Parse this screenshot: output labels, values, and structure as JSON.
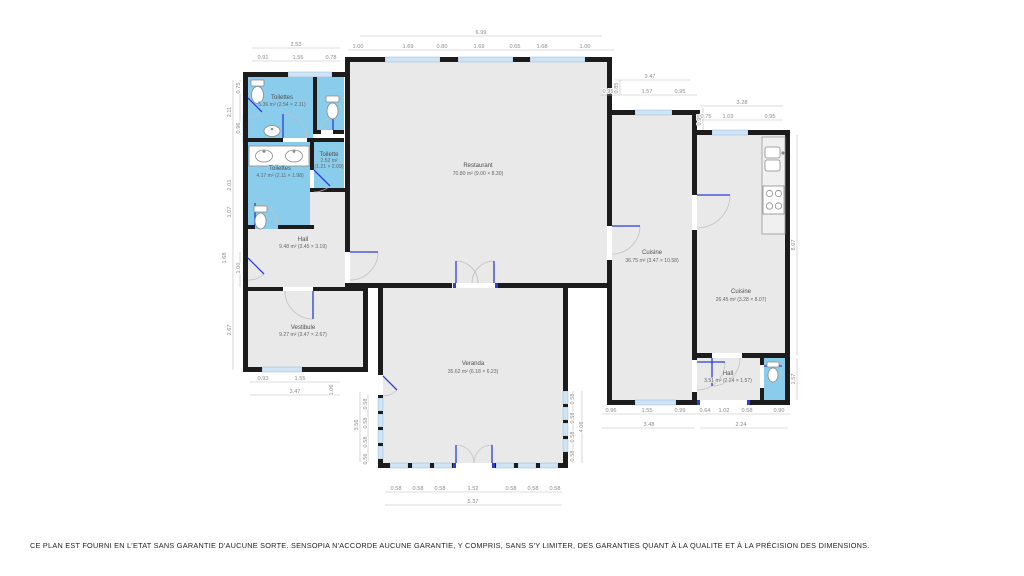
{
  "disclaimer": "CE PLAN EST FOURNI EN L'ETAT SANS GARANTIE D'AUCUNE SORTE. SENSOPIA N'ACCORDE AUCUNE GARANTIE, Y COMPRIS, SANS S'Y LIMITER, DES GARANTIES QUANT À LA QUALITE ET À LA PRÉCISION DES DIMENSIONS.",
  "plan": {
    "rooms": [
      {
        "name": "Toilettes",
        "details": "5.36 m² (2.54 × 2.11)"
      },
      {
        "name": "Toilettes",
        "details": "4.17 m² (2.11 × 1.98)"
      },
      {
        "name": "Toilette",
        "details": "2.52 m²",
        "details2": "(1.21 × 2.09)"
      },
      {
        "name": "Hall",
        "details": "9.48 m² (3.45 × 3.19)"
      },
      {
        "name": "Vestibule",
        "details": "9.27 m² (3.47 × 2.67)"
      },
      {
        "name": "Restaurant",
        "details": "70.80 m² (9.00 × 8.30)"
      },
      {
        "name": "Cuisine",
        "details": "36.75 m² (3.47 × 10.58)"
      },
      {
        "name": "Cuisine",
        "details": "26.45 m² (3.28 × 8.07)"
      },
      {
        "name": "Veranda",
        "details": "35.62 m² (6.18 × 6.23)"
      },
      {
        "name": "Hall",
        "details": "3.51 m² (2.24 × 1.57)"
      }
    ],
    "dims": {
      "top_left": {
        "total": "2.53",
        "parts": [
          "0.91",
          "1.55",
          "0.78"
        ]
      },
      "top_center": {
        "total": "6.99",
        "parts": [
          "1.00",
          "1.69",
          "0.80",
          "1.69",
          "0.65",
          "1.68",
          "1.00"
        ]
      },
      "top_right": {
        "total": "3.47",
        "parts": [
          "0.95",
          "1.57",
          "0.95"
        ]
      },
      "step_vertical": [
        "0.85",
        "0.95"
      ],
      "far_right_top": {
        "total": "3.28",
        "parts": [
          "0.75",
          "1.03",
          "0.95"
        ]
      },
      "left_edge": [
        "0.75",
        "2.11",
        "0.96",
        "2.01",
        "1.07",
        "1.68",
        "1.00",
        "2.67"
      ],
      "right_edge": [
        "8.07",
        "1.57"
      ],
      "bottom_left": {
        "total": "3.47",
        "parts": [
          "0.93",
          "1.55"
        ],
        "side": "1.06"
      },
      "veranda_left": [
        "3.56",
        "0.58",
        "0.58",
        "0.58",
        "0.56"
      ],
      "veranda_right": [
        "0.58",
        "0.58",
        "0.58",
        "0.58",
        "4.06"
      ],
      "veranda_bottom": {
        "total": "5.37",
        "parts": [
          "0.58",
          "0.58",
          "0.58",
          "1.52",
          "0.58",
          "0.58",
          "0.58"
        ]
      },
      "bottom_right": {
        "totals": [
          "3.48",
          "2.24"
        ],
        "parts": [
          "0.96",
          "1.55",
          "0.99",
          "0.64",
          "1.02",
          "0.58",
          "0.90"
        ]
      }
    },
    "colors": {
      "wall": "#1c1c1c",
      "room": "#e9e9e9",
      "wet_room": "#8accec",
      "window": "#cfe4f5",
      "door": "#2b3fd4"
    }
  }
}
